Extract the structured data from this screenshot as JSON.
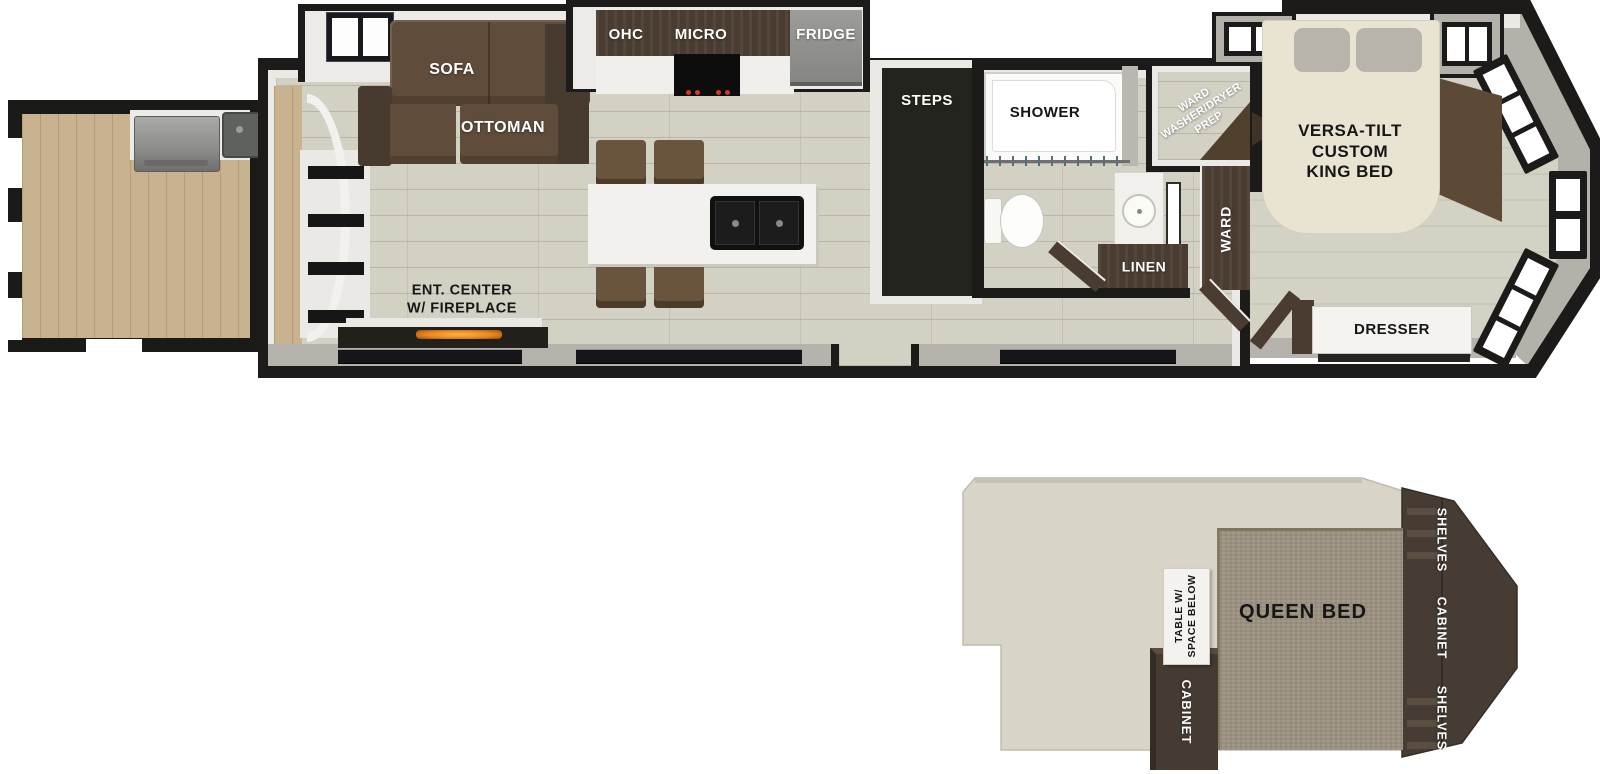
{
  "labels": {
    "sofa": "SOFA",
    "ottoman": "OTTOMAN",
    "ohc": "OHC",
    "micro": "MICRO",
    "fridge": "FRIDGE",
    "ent_center": "ENT. CENTER\nW/ FIREPLACE",
    "steps": "STEPS",
    "shower": "SHOWER",
    "ward_wd_prep": "WARD\nWASHER/DRYER\nPREP",
    "ward": "WARD",
    "linen": "LINEN",
    "king_bed": "VERSA-TILT\nCUSTOM\nKING BED",
    "dresser": "DRESSER",
    "queen_bed": "QUEEN BED",
    "shelves_top": "SHELVES",
    "cabinet_side": "CABINET",
    "shelves_bottom": "SHELVES",
    "table": "TABLE W/\nSPACE BELOW",
    "cabinet_loft": "CABINET"
  },
  "colors": {
    "wall": "#1c1b19",
    "wall_grey": "#b3b1a9",
    "floor": "#d3d0c4",
    "deck_wood": "#c9b290",
    "furniture_brown": "#5f4c3a",
    "cabinet_brown": "#4a3c30",
    "bed_cream": "#e9e3d1",
    "loft_bed": "#9a9080",
    "fire_accent": "#e8871e"
  }
}
